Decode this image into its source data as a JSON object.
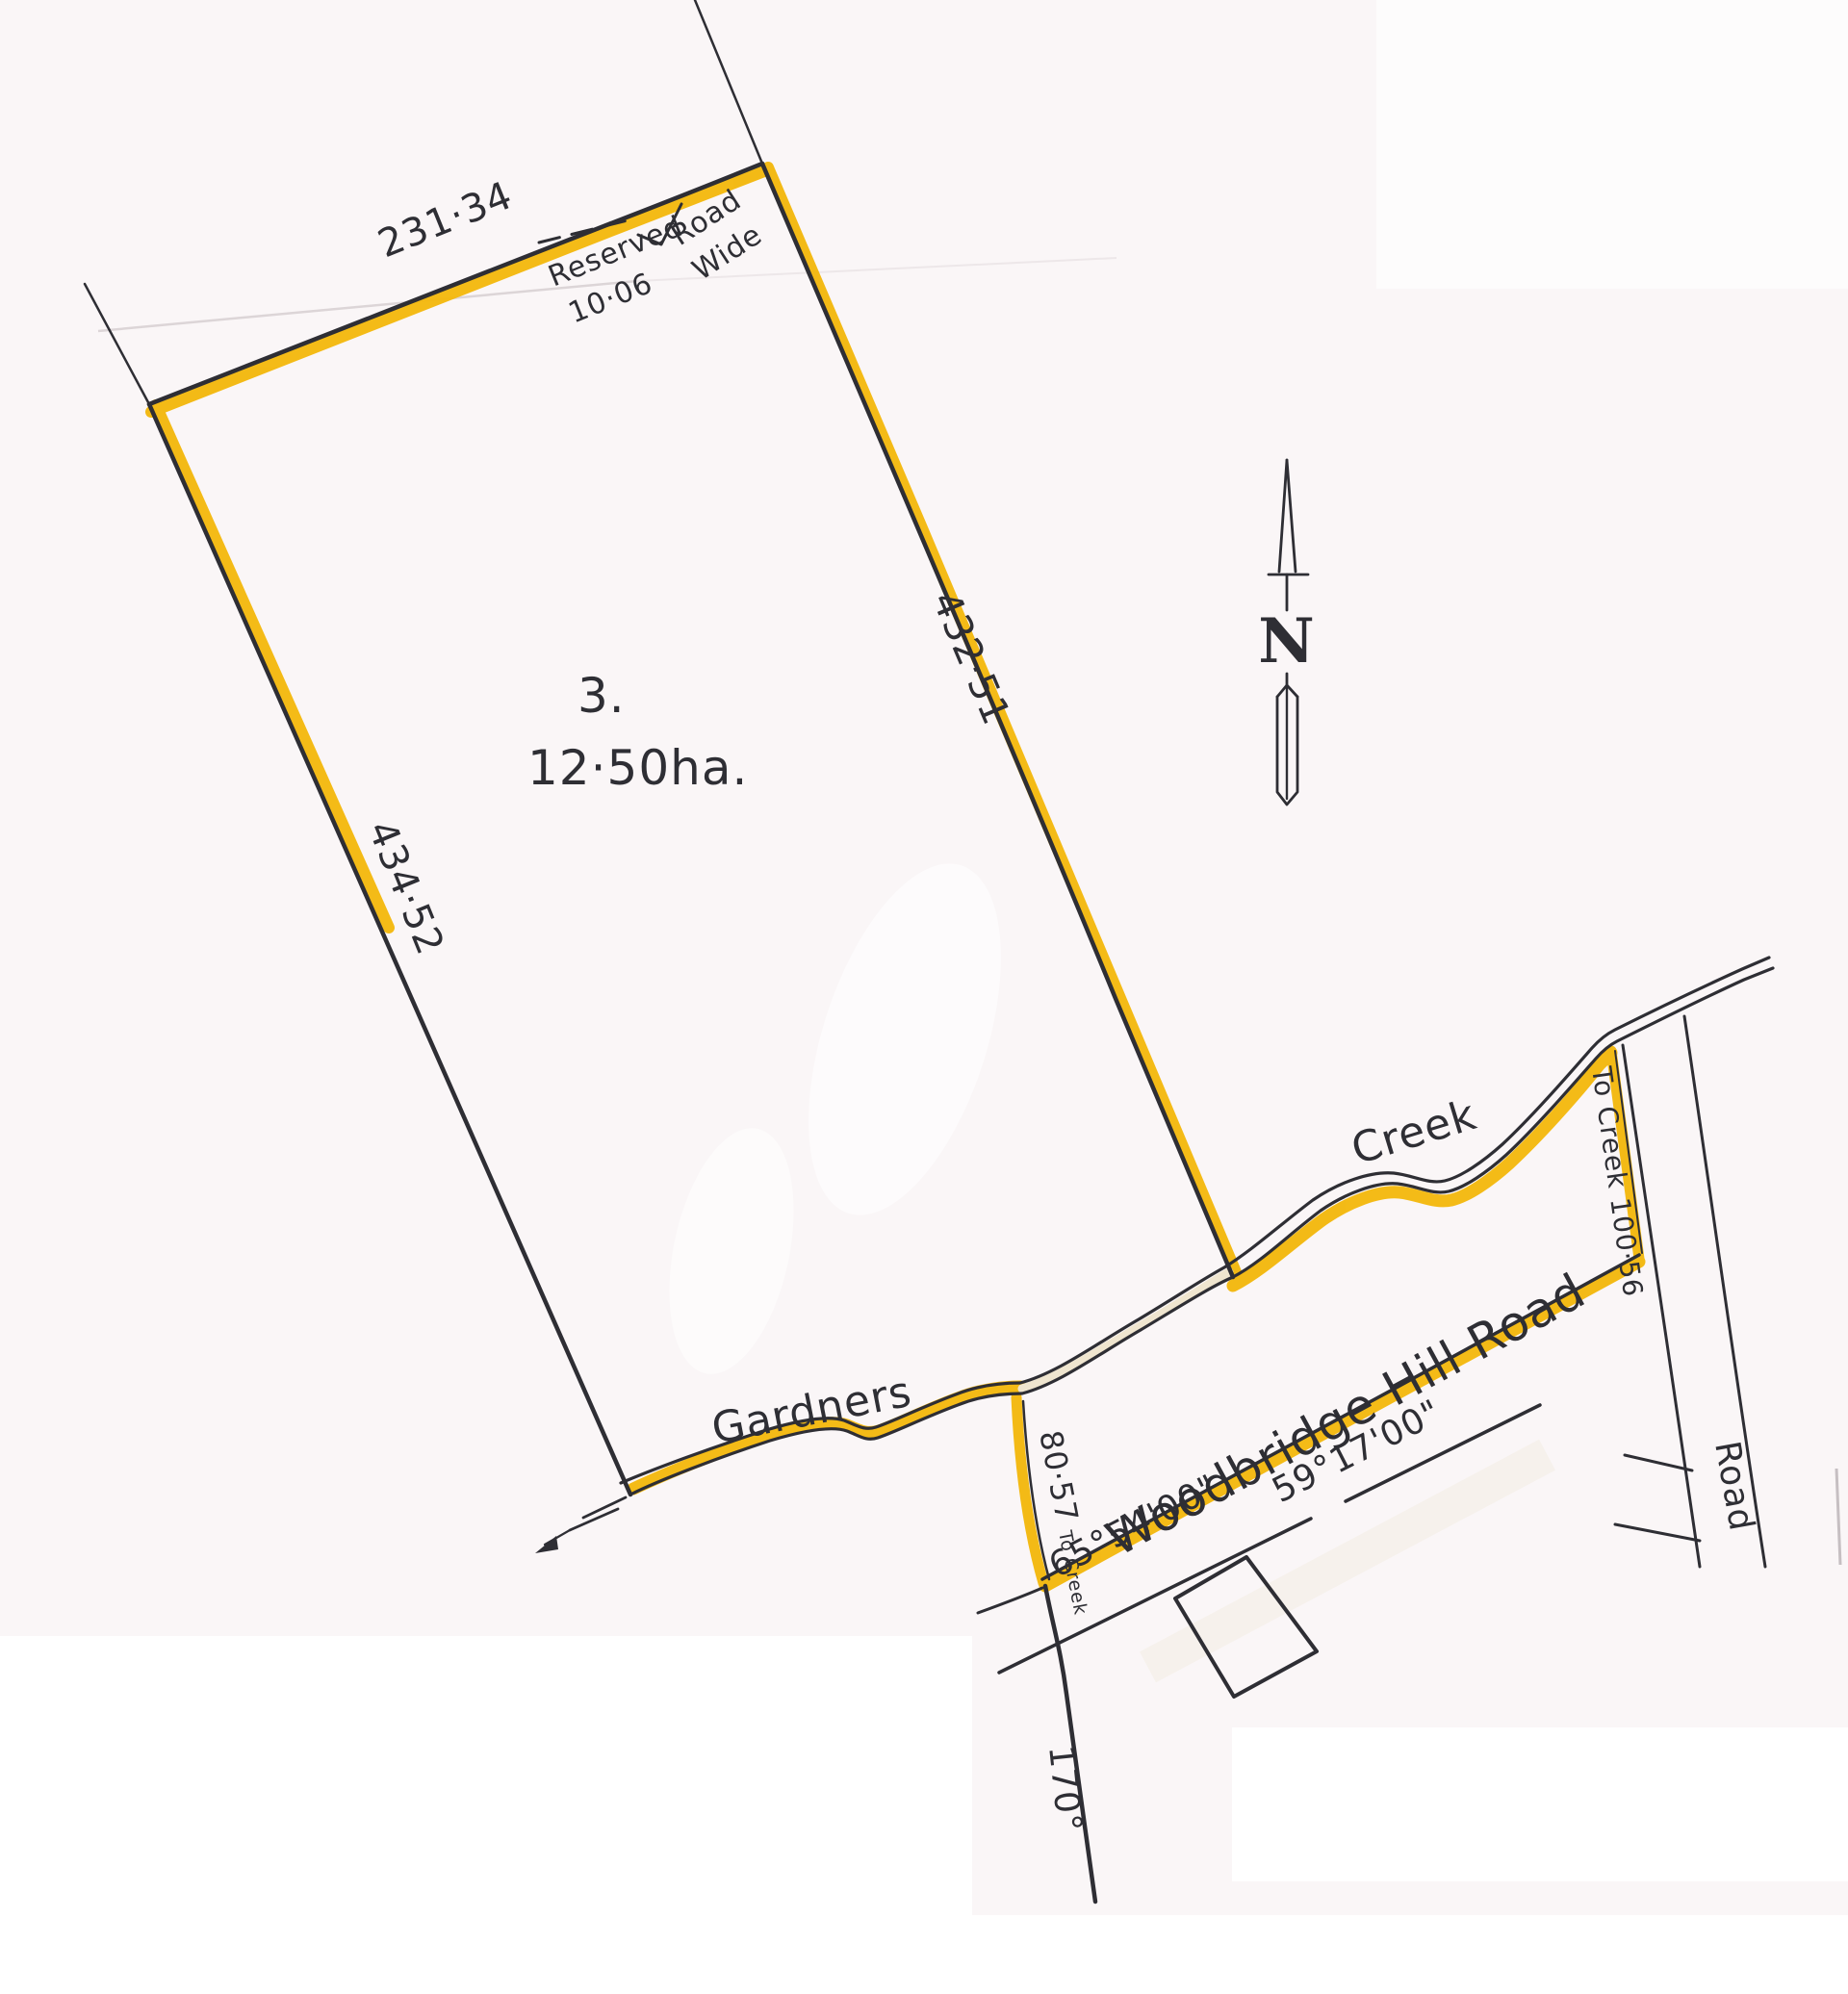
{
  "plan": {
    "lot_number": "3.",
    "lot_area": "12·50ha.",
    "north_label": "N",
    "measure_top": "231·34",
    "measure_right": "432·51",
    "measure_left": "434·52",
    "reserved_road": {
      "word1": "Reserved",
      "word2": "10·06",
      "word3": "Road",
      "word4": "Wide"
    },
    "creek_labels": {
      "west": "Gardners",
      "east": "Creek"
    },
    "road_labels": {
      "main": "Woodbridge Hill Road",
      "side": "Road"
    },
    "bearings": {
      "b65": "65°54'00\"",
      "b59": "59°17'00\"",
      "b170": "170°"
    },
    "distances": {
      "to_creek_west": "80·57",
      "to_creek_west_note": "To Creek",
      "to_creek_east": "To Creek 100·56"
    },
    "colors": {
      "paper": "#FAF6F7",
      "ink": "#2E2E34",
      "highlight": "#F3B70B",
      "cream": "#EFE5CF"
    }
  }
}
